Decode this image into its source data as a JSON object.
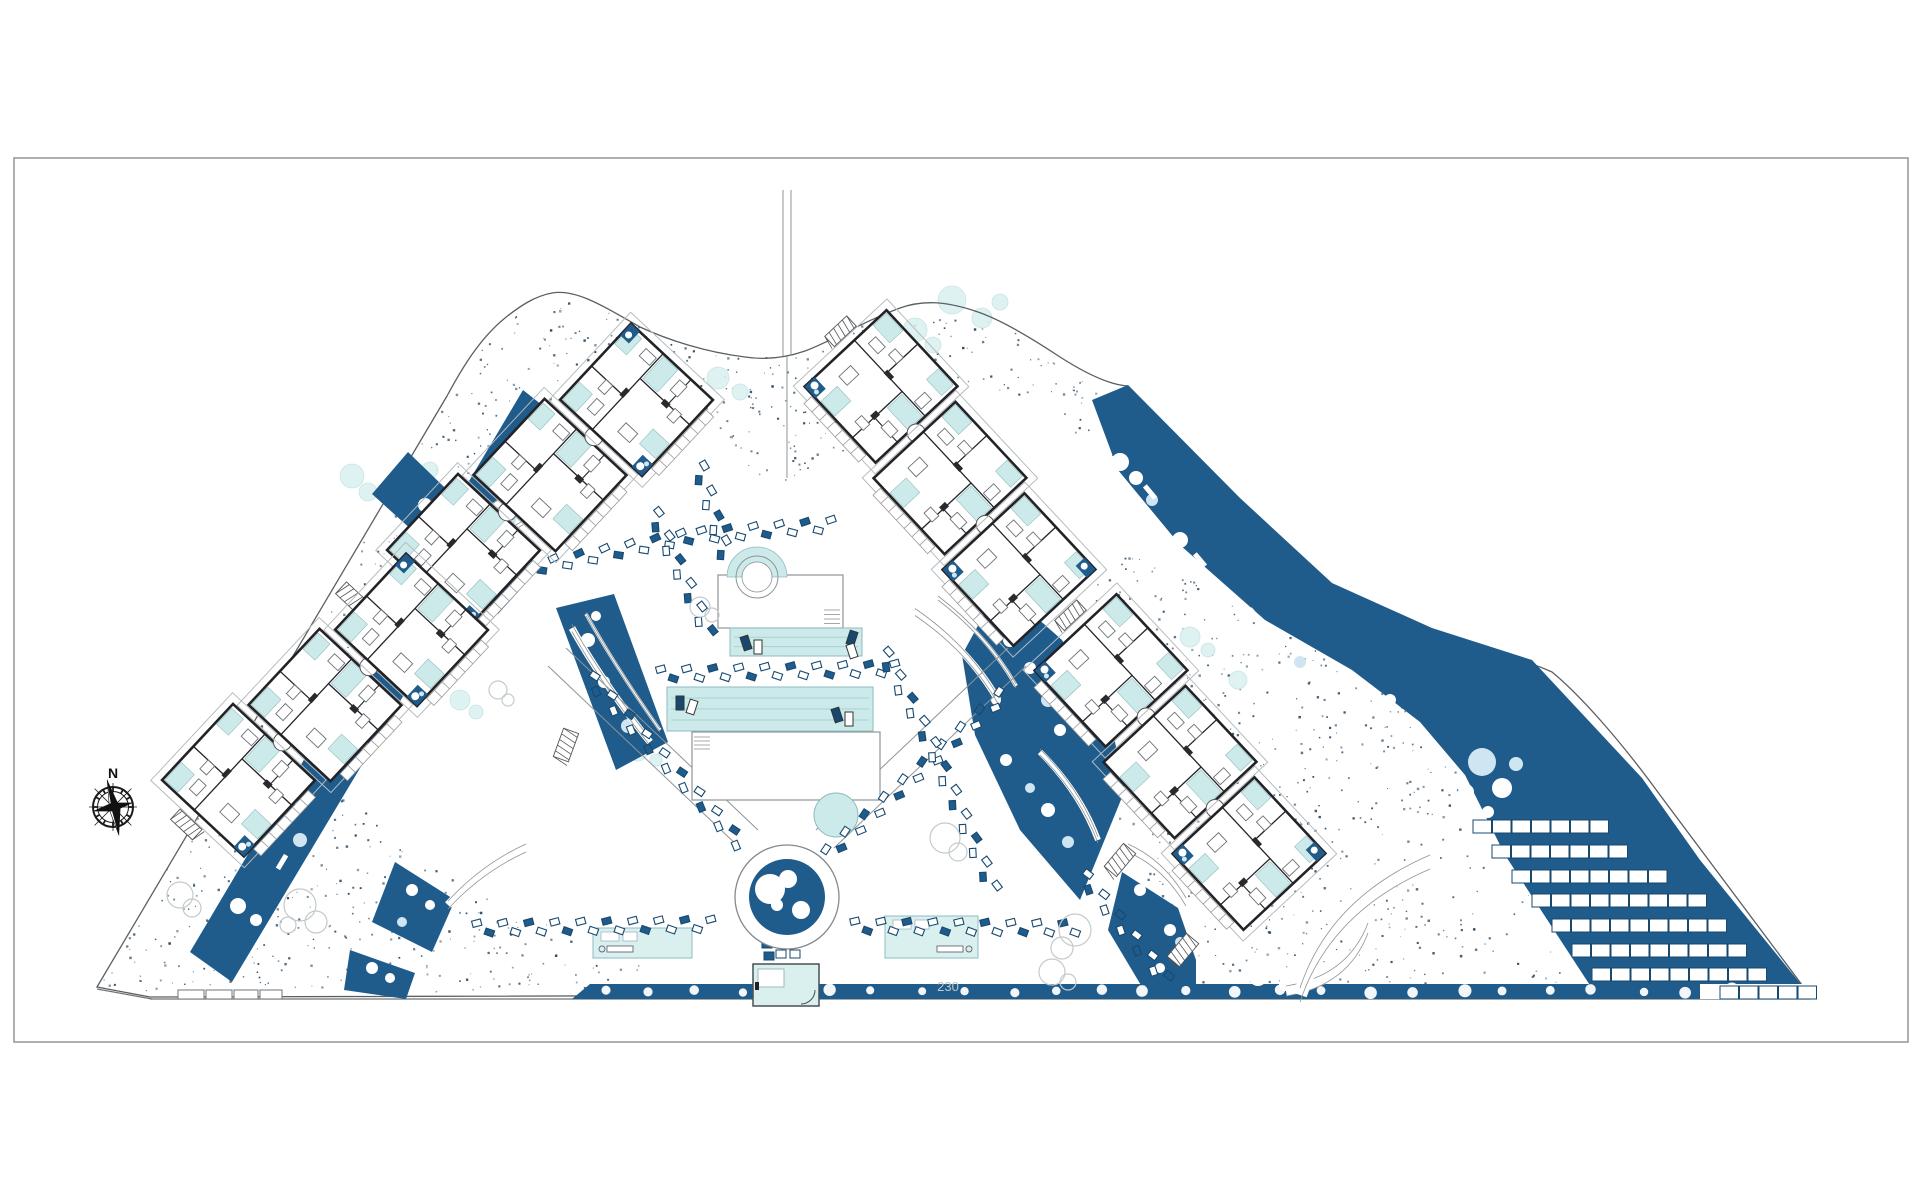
{
  "compass": {
    "label": "N",
    "cx": 113,
    "cy": 807
  },
  "annotations": {
    "dimension": "230",
    "dimension_x": 948,
    "dimension_y": 991
  },
  "colors": {
    "paper": "#ffffff",
    "frame": "#9b9b9b",
    "boundary": "#5a5f63",
    "navy": "#1f5b8b",
    "navy_dark": "#17496f",
    "stipple": "#20405a",
    "teal": "#cdeaea",
    "teal_soft": "#d9f0ef",
    "teal_stroke": "#8fbcc1",
    "lane": "#a5d2d4",
    "wall": "#232327",
    "gray_line": "#8f9496",
    "light_gray": "#c3cacc",
    "bush_blue": "#cfe6f2"
  },
  "frame": {
    "x": 14,
    "y": 158,
    "w": 1894,
    "h": 884
  },
  "boundary_d": "M97,987 L447,396 C460,372 478,340 505,318 C520,306 535,296 552,293 C575,289 600,304 640,327 C668,340 705,352 745,357 C765,360 785,358 805,351 C830,342 862,322 900,308 C922,300 945,301 975,311 C1000,319 1030,337 1060,357 C1085,373 1110,385 1128,386 L1265,528 C1295,560 1330,590 1365,607 C1398,623 1432,633 1462,643 C1492,652 1525,660 1552,672 C1580,695 1620,740 1660,795 L1808,993 L150,997 Z",
  "road": {
    "main": [
      150,
      999,
      1810,
      999
    ],
    "corner": [
      97,
      989,
      152,
      999
    ],
    "wall_segments": [
      [
        178,
        990,
        26,
        9
      ],
      [
        206,
        990,
        26,
        9
      ],
      [
        234,
        990,
        24,
        9
      ],
      [
        260,
        990,
        22,
        9
      ]
    ]
  },
  "top_path": {
    "lines": [
      [
        783,
        190,
        783,
        356
      ],
      [
        791,
        190,
        791,
        356
      ],
      [
        787,
        356,
        787,
        478
      ]
    ]
  },
  "x_paths": [
    [
      548,
      666,
      740,
      848
    ],
    [
      566,
      648,
      758,
      830
    ],
    [
      834,
      848,
      1026,
      666
    ],
    [
      816,
      830,
      1008,
      648
    ]
  ],
  "stipple_regions": [
    {
      "pts": [
        447,
        396,
        505,
        318,
        552,
        293,
        600,
        304,
        640,
        327,
        690,
        347,
        745,
        357,
        787,
        357,
        830,
        342,
        870,
        320,
        910,
        306,
        950,
        302,
        985,
        313,
        1030,
        337,
        1070,
        362,
        1100,
        380,
        1128,
        386,
        1150,
        420,
        1118,
        470,
        1085,
        440,
        1040,
        420,
        990,
        395,
        940,
        370,
        905,
        382,
        868,
        412,
        838,
        458,
        812,
        480,
        787,
        484,
        760,
        476,
        732,
        450,
        700,
        417,
        662,
        386,
        628,
        373,
        596,
        374,
        562,
        390,
        530,
        420,
        500,
        452,
        470,
        432
      ],
      "density": 0.005
    },
    {
      "pts": [
        97,
        987,
        447,
        396,
        512,
        438,
        458,
        528,
        408,
        598,
        362,
        662,
        332,
        715,
        372,
        790,
        432,
        856,
        502,
        906,
        576,
        936,
        640,
        950,
        646,
        993,
        154,
        993
      ],
      "density": 0.0042
    },
    {
      "pts": [
        1098,
        542,
        1162,
        562,
        1242,
        612,
        1332,
        657,
        1402,
        702,
        1452,
        762,
        1502,
        852,
        1562,
        950,
        1586,
        993,
        1152,
        993,
        1112,
        852,
        1088,
        700
      ],
      "density": 0.0042
    }
  ],
  "teal_bushes": [
    [
      352,
      476,
      12
    ],
    [
      368,
      492,
      9
    ],
    [
      396,
      488,
      10
    ],
    [
      430,
      470,
      8
    ],
    [
      718,
      378,
      11
    ],
    [
      740,
      392,
      8
    ],
    [
      915,
      330,
      12
    ],
    [
      933,
      345,
      8
    ],
    [
      952,
      300,
      14
    ],
    [
      982,
      318,
      10
    ],
    [
      1000,
      302,
      8
    ],
    [
      1190,
      637,
      10
    ],
    [
      1208,
      650,
      7
    ],
    [
      460,
      700,
      10
    ],
    [
      476,
      712,
      7
    ],
    [
      638,
      752,
      9
    ],
    [
      656,
      760,
      6
    ],
    [
      1238,
      680,
      9
    ],
    [
      480,
      560,
      8
    ]
  ],
  "navy_polys": [
    {
      "name": "left-strip",
      "pts": [
        190,
        952,
        523,
        390,
        566,
        424,
        232,
        982
      ],
      "bushes": [
        [
          238,
          906,
          8
        ],
        [
          256,
          920,
          6
        ],
        [
          300,
          840,
          7
        ],
        [
          360,
          742,
          8
        ],
        [
          376,
          756,
          6
        ],
        [
          420,
          664,
          8
        ],
        [
          470,
          582,
          7
        ],
        [
          486,
          566,
          5
        ],
        [
          510,
          520,
          6
        ],
        [
          532,
          470,
          7
        ],
        [
          546,
          448,
          5
        ]
      ],
      "dashes": [
        [
          282,
          862,
          -59
        ],
        [
          398,
          672,
          -59
        ],
        [
          505,
          492,
          -59
        ]
      ]
    },
    {
      "name": "gap-upper-left",
      "pts": [
        408,
        452,
        472,
        514,
        536,
        572,
        498,
        614,
        434,
        550,
        372,
        494
      ],
      "bushes": [
        [
          425,
          505,
          7
        ],
        [
          452,
          530,
          6
        ],
        [
          470,
          548,
          5
        ]
      ],
      "dashes": []
    },
    {
      "name": "gap-mid-left",
      "pts": [
        556,
        608,
        614,
        594,
        668,
        742,
        616,
        770
      ],
      "bushes": [
        [
          588,
          640,
          7
        ],
        [
          604,
          682,
          6
        ],
        [
          628,
          726,
          7
        ],
        [
          596,
          616,
          5
        ]
      ],
      "dashes": []
    },
    {
      "name": "gap-right",
      "pts": [
        1000,
        585,
        1062,
        640,
        1110,
        718,
        1125,
        790,
        1080,
        900,
        1020,
        830,
        975,
        735,
        962,
        655
      ],
      "bushes": [
        [
          1010,
          640,
          7
        ],
        [
          1030,
          668,
          6
        ],
        [
          1048,
          700,
          7
        ],
        [
          1060,
          730,
          6
        ],
        [
          1048,
          810,
          7
        ],
        [
          1068,
          842,
          6
        ],
        [
          996,
          700,
          5
        ],
        [
          1006,
          760,
          6
        ],
        [
          1030,
          788,
          5
        ]
      ],
      "dashes": []
    },
    {
      "name": "right-band-parking",
      "pts": [
        1092,
        400,
        1128,
        385,
        1240,
        498,
        1332,
        583,
        1432,
        628,
        1532,
        660,
        1642,
        778,
        1700,
        860,
        1808,
        993,
        1595,
        993,
        1505,
        855,
        1465,
        775,
        1420,
        722,
        1352,
        670,
        1265,
        620,
        1180,
        545,
        1118,
        470
      ],
      "bushes": [
        [
          1120,
          462,
          9
        ],
        [
          1136,
          478,
          7
        ],
        [
          1152,
          500,
          6
        ],
        [
          1180,
          540,
          8
        ],
        [
          1262,
          640,
          7
        ],
        [
          1300,
          662,
          6
        ],
        [
          1330,
          680,
          7
        ],
        [
          1390,
          700,
          6
        ],
        [
          1482,
          762,
          14
        ],
        [
          1502,
          788,
          10
        ],
        [
          1466,
          792,
          8
        ],
        [
          1516,
          764,
          7
        ],
        [
          1488,
          812,
          6
        ]
      ],
      "dashes": [
        [
          1200,
          560,
          50
        ],
        [
          1255,
          615,
          50
        ],
        [
          1150,
          492,
          50
        ]
      ]
    },
    {
      "name": "hedge",
      "pts": [
        572,
        999,
        590,
        984,
        1806,
        984,
        1806,
        999
      ],
      "bushes": [],
      "dashes": []
    },
    {
      "name": "bottom-left-a",
      "pts": [
        395,
        862,
        455,
        900,
        432,
        952,
        372,
        922
      ],
      "bushes": [
        [
          412,
          890,
          6
        ],
        [
          430,
          905,
          5
        ],
        [
          402,
          922,
          5
        ]
      ],
      "dashes": []
    },
    {
      "name": "bottom-left-b",
      "pts": [
        350,
        950,
        415,
        973,
        406,
        999,
        344,
        990
      ],
      "bushes": [
        [
          372,
          968,
          6
        ],
        [
          390,
          978,
          5
        ]
      ],
      "dashes": []
    },
    {
      "name": "bottom-right-a",
      "pts": [
        1122,
        872,
        1178,
        908,
        1196,
        960,
        1196,
        997,
        1148,
        997,
        1108,
        930
      ],
      "bushes": [
        [
          1140,
          890,
          6
        ],
        [
          1170,
          930,
          6
        ],
        [
          1180,
          942,
          5
        ],
        [
          1160,
          968,
          5
        ]
      ],
      "dashes": []
    }
  ],
  "white_arcs": [
    {
      "d": "M445,545 Q480,512 520,492",
      "w": 8
    },
    {
      "d": "M465,565 Q495,538 528,520",
      "w": 4
    },
    {
      "d": "M572,628 Q602,682 650,742",
      "w": 7
    },
    {
      "d": "M586,614 Q616,668 660,730",
      "w": 3.5
    },
    {
      "d": "M915,612 Q968,648 998,700",
      "w": 7
    },
    {
      "d": "M938,598 Q988,636 1016,686",
      "w": 4
    },
    {
      "d": "M1040,752 Q1080,792 1098,840",
      "w": 6
    },
    {
      "d": "M448,905 Q482,868 526,848",
      "w": 8
    },
    {
      "d": "M1128,848 Q1164,864 1186,902",
      "w": 8
    },
    {
      "d": "M1286,991 Q1348,981 1368,928",
      "w": 10
    },
    {
      "d": "M1300,995 Q1330,905 1430,862",
      "w": 14
    }
  ],
  "parking_rows": [
    {
      "x": 1473,
      "y": 820,
      "n": 7
    },
    {
      "x": 1492,
      "y": 845,
      "n": 7
    },
    {
      "x": 1512,
      "y": 870,
      "n": 8
    },
    {
      "x": 1532,
      "y": 894,
      "n": 9
    },
    {
      "x": 1552,
      "y": 919,
      "n": 9
    },
    {
      "x": 1572,
      "y": 944,
      "n": 9
    },
    {
      "x": 1592,
      "y": 968,
      "n": 9
    },
    {
      "x": 1720,
      "y": 986,
      "n": 5
    }
  ],
  "hatches": [
    [
      352,
      598,
      -47
    ],
    [
      287,
      790,
      -59
    ],
    [
      400,
      598,
      -59
    ],
    [
      566,
      745,
      20
    ],
    [
      1120,
      860,
      40
    ],
    [
      1183,
      950,
      40
    ]
  ],
  "amenity": {
    "deckA": [
      718,
      575,
      125,
      53
    ],
    "spa_center": [
      757,
      577
    ],
    "poolA": [
      730,
      628,
      132,
      28
    ],
    "poolB": [
      667,
      687,
      206,
      44
    ],
    "deckB": [
      692,
      732,
      188,
      68
    ],
    "teal_circle": [
      836,
      815,
      22
    ],
    "cabanaL": [
      593,
      928,
      99,
      30
    ],
    "cabanaR": [
      885,
      916,
      93,
      42
    ],
    "pavilion": [
      753,
      964,
      66,
      42
    ],
    "plaza": {
      "cx": 787,
      "cy": 897,
      "r_outer": 52,
      "r_navy": 38,
      "spa_circles": [
        [
          770,
          889,
          15
        ],
        [
          788,
          879,
          9
        ],
        [
          801,
          910,
          9
        ],
        [
          777,
          905,
          6
        ]
      ]
    }
  },
  "chains": [
    [
      530,
      568,
      690,
      536,
      838,
      524
    ],
    [
      662,
      674,
      908,
      668
    ],
    [
      592,
      680,
      748,
      852
    ],
    [
      830,
      852,
      1008,
      690
    ],
    [
      478,
      928,
      718,
      924
    ],
    [
      856,
      926,
      1082,
      928
    ],
    [
      885,
      655,
      932,
      745,
      995,
      893
    ],
    [
      655,
      515,
      712,
      640
    ],
    [
      700,
      468,
      727,
      560
    ],
    [
      1085,
      878,
      1168,
      982
    ]
  ],
  "buildings": [
    {
      "id": "block-nw",
      "cx": 550,
      "cy": 475,
      "angle": -47
    },
    {
      "id": "block-sw",
      "cx": 325,
      "cy": 705,
      "angle": -47
    },
    {
      "id": "block-ne",
      "cx": 950,
      "cy": 478,
      "angle": 47
    },
    {
      "id": "block-se",
      "cx": 1180,
      "cy": 762,
      "angle": 47
    }
  ],
  "gray_trees": [
    [
      [
        300,
        905,
        16
      ],
      [
        316,
        922,
        11
      ],
      [
        288,
        925,
        8
      ]
    ],
    [
      [
        945,
        838,
        15
      ],
      [
        958,
        852,
        9
      ]
    ],
    [
      [
        700,
        607,
        10
      ],
      [
        712,
        615,
        7
      ]
    ],
    [
      [
        1075,
        930,
        16
      ],
      [
        1062,
        948,
        11
      ]
    ],
    [
      [
        1052,
        972,
        13
      ],
      [
        1068,
        982,
        8
      ]
    ],
    [
      [
        180,
        895,
        13
      ],
      [
        192,
        908,
        9
      ]
    ],
    [
      [
        498,
        690,
        9
      ],
      [
        508,
        700,
        6
      ]
    ]
  ]
}
